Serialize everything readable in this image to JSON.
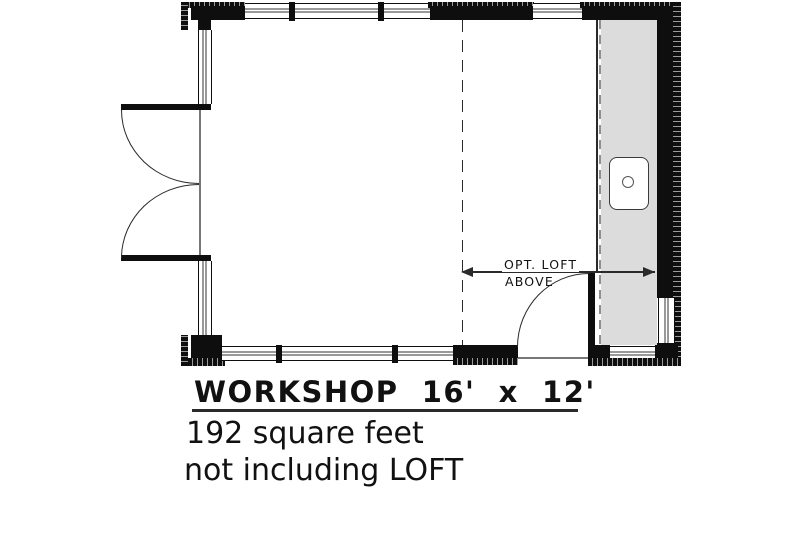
{
  "colors": {
    "wall": "#0e0e0e",
    "hatch": "#9a9a9a",
    "loft_fill": "#dcdcdc",
    "glass": "#999999",
    "line": "#2a2a2a",
    "dash_light": "#8f8f8f",
    "text": "#111111",
    "background": "#ffffff"
  },
  "annotations": {
    "loft_label_line1": "OPT. LOFT",
    "loft_label_line2": "ABOVE"
  },
  "caption": {
    "title": "WORKSHOP  16'  x  12'",
    "area": "192 square feet",
    "note": "not including LOFT"
  },
  "fixtures": {
    "sink_icon": "sink-basin"
  }
}
